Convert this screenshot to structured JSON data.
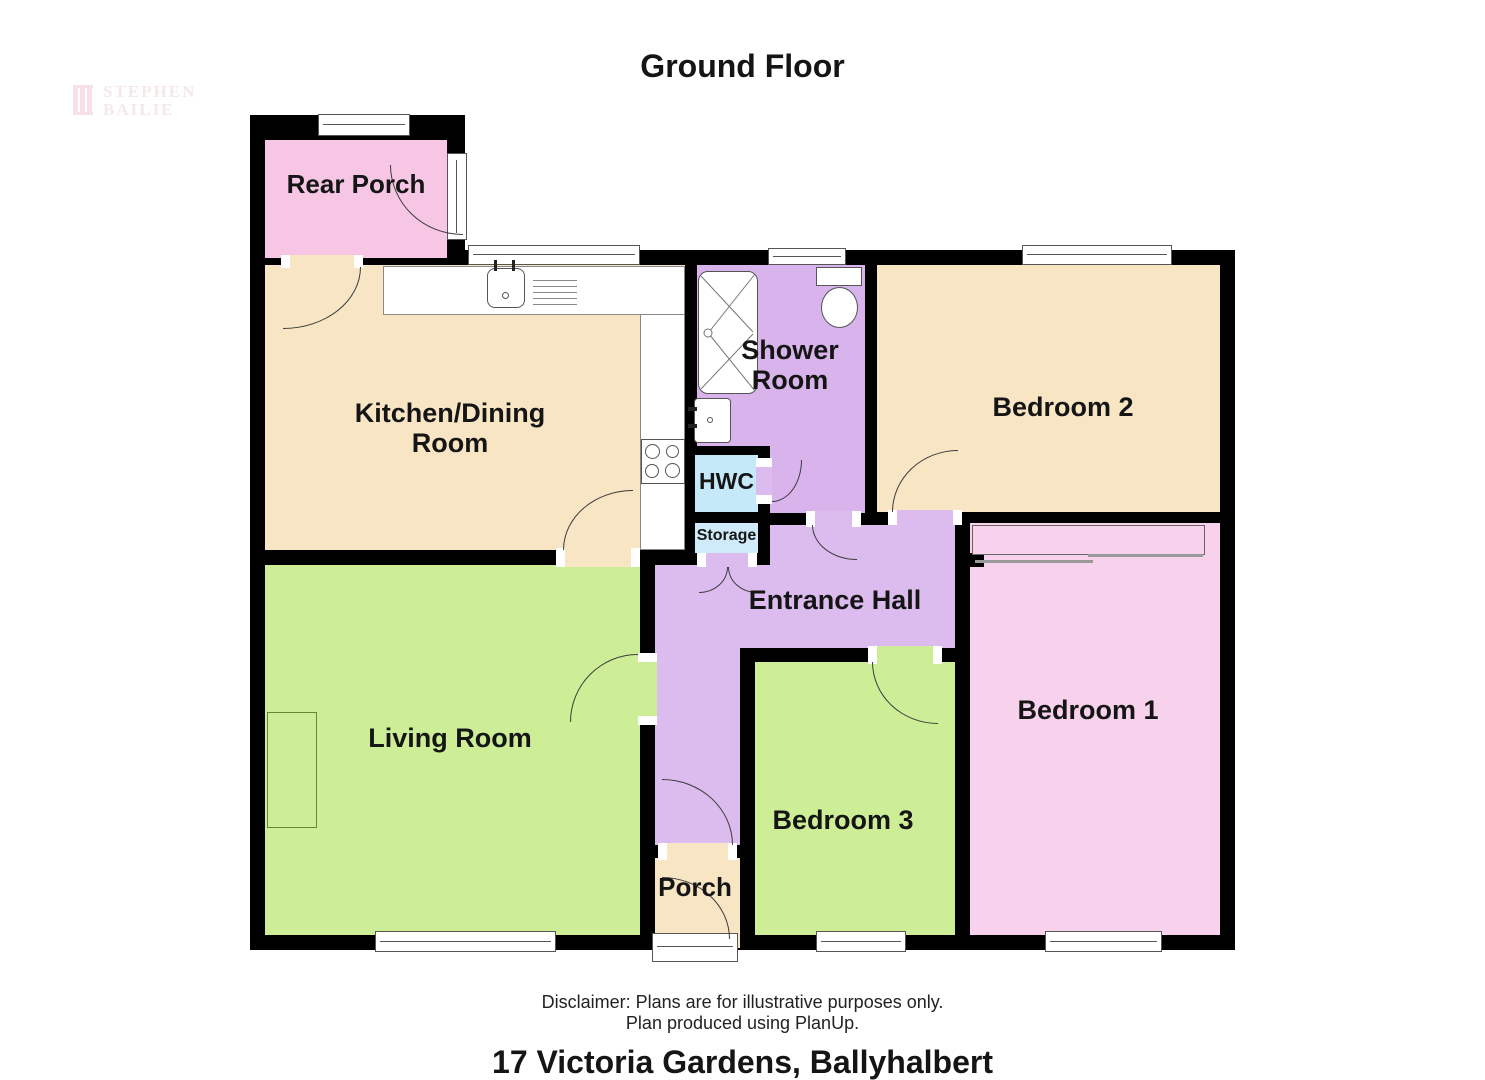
{
  "page": {
    "title": "Ground Floor",
    "address": "17 Victoria Gardens, Ballyhalbert",
    "disclaimer_line1": "Disclaimer: Plans are for illustrative purposes only.",
    "disclaimer_line2": "Plan produced using PlanUp.",
    "watermark": {
      "line1": "STEPHEN",
      "line2": "BAILIE"
    }
  },
  "rooms": [
    {
      "id": "rear-porch",
      "label": "Rear Porch",
      "color": "#f8c6e5"
    },
    {
      "id": "kitchen-dining",
      "label": "Kitchen/Dining Room",
      "color": "#f7e5c4"
    },
    {
      "id": "shower-room",
      "label": "Shower Room",
      "color": "#d9b4ec"
    },
    {
      "id": "bedroom-2",
      "label": "Bedroom 2",
      "color": "#f7e5c4"
    },
    {
      "id": "hwc",
      "label": "HWC",
      "color": "#c5e9f8"
    },
    {
      "id": "storage",
      "label": "Storage",
      "color": "#cfeaf8"
    },
    {
      "id": "entrance-hall",
      "label": "Entrance Hall",
      "color": "#dcbbee"
    },
    {
      "id": "living-room",
      "label": "Living Room",
      "color": "#cdee97"
    },
    {
      "id": "bedroom-3",
      "label": "Bedroom 3",
      "color": "#cdee97"
    },
    {
      "id": "bedroom-1",
      "label": "Bedroom 1",
      "color": "#f8d2ec"
    },
    {
      "id": "porch",
      "label": "Porch",
      "color": "#f7e5c4"
    }
  ],
  "fixtures": [
    "kitchen-sink",
    "drainer",
    "hob",
    "shower-tray",
    "toilet",
    "washbasin",
    "wardrobe-sliding-doors",
    "fireplace"
  ],
  "colors": {
    "wall": "#000000",
    "background": "#ffffff",
    "window_frame": "#555555",
    "door_arc": "#3c3c3c",
    "watermark_pink": "#f2c9d2"
  }
}
